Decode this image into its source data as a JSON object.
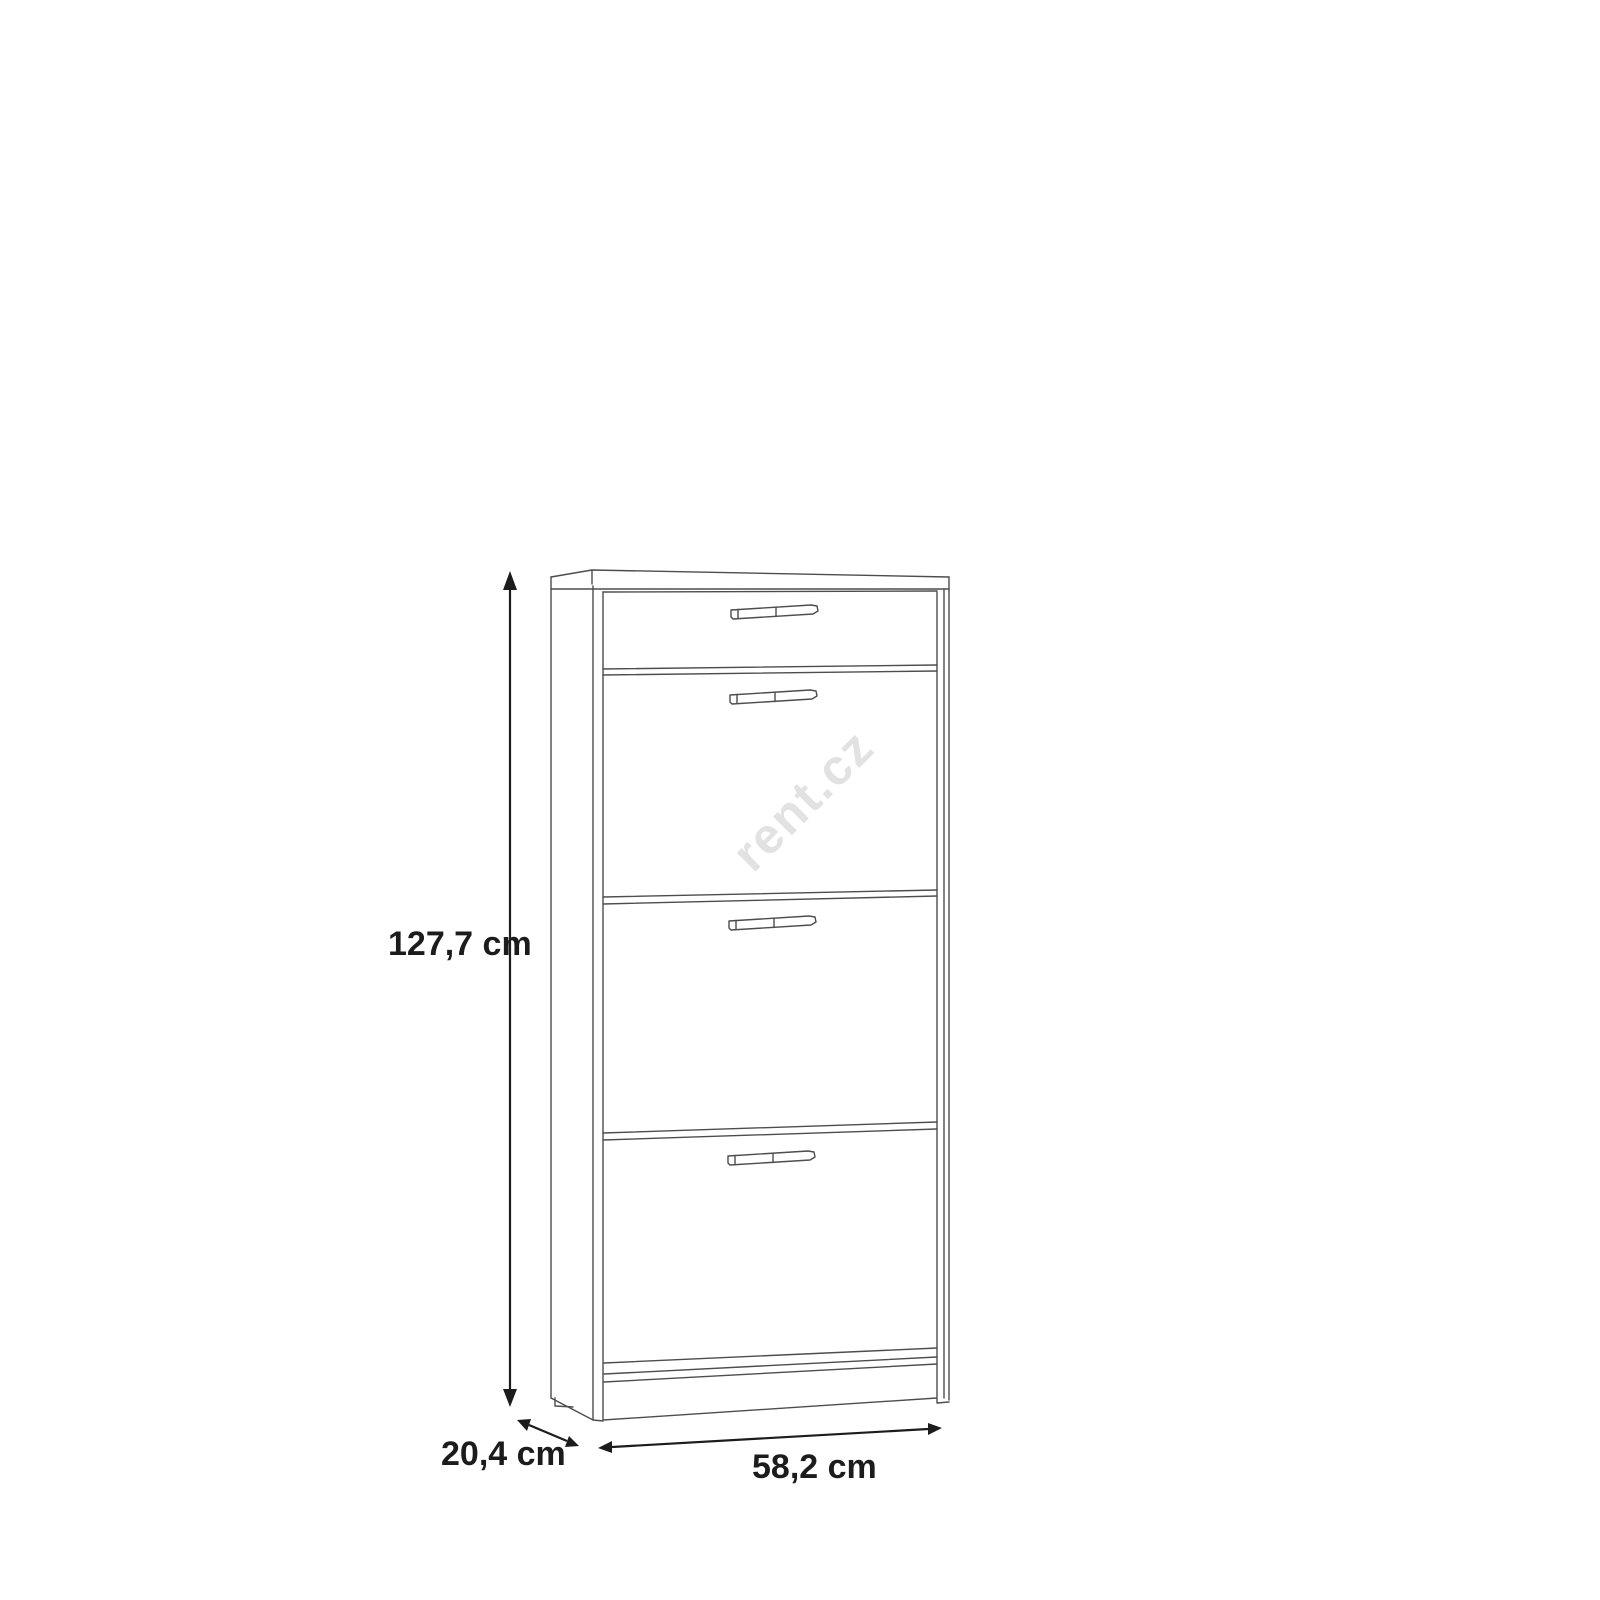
{
  "watermark": {
    "text": "rent.cz",
    "color": "#e2e2e2"
  },
  "dimensions": {
    "height": "127,7 cm",
    "depth": "20,4 cm",
    "width": "58,2 cm"
  },
  "drawing": {
    "line_color": "#4d4d4d",
    "dimension_color": "#1c1c1c",
    "background_color": "#ffffff"
  }
}
